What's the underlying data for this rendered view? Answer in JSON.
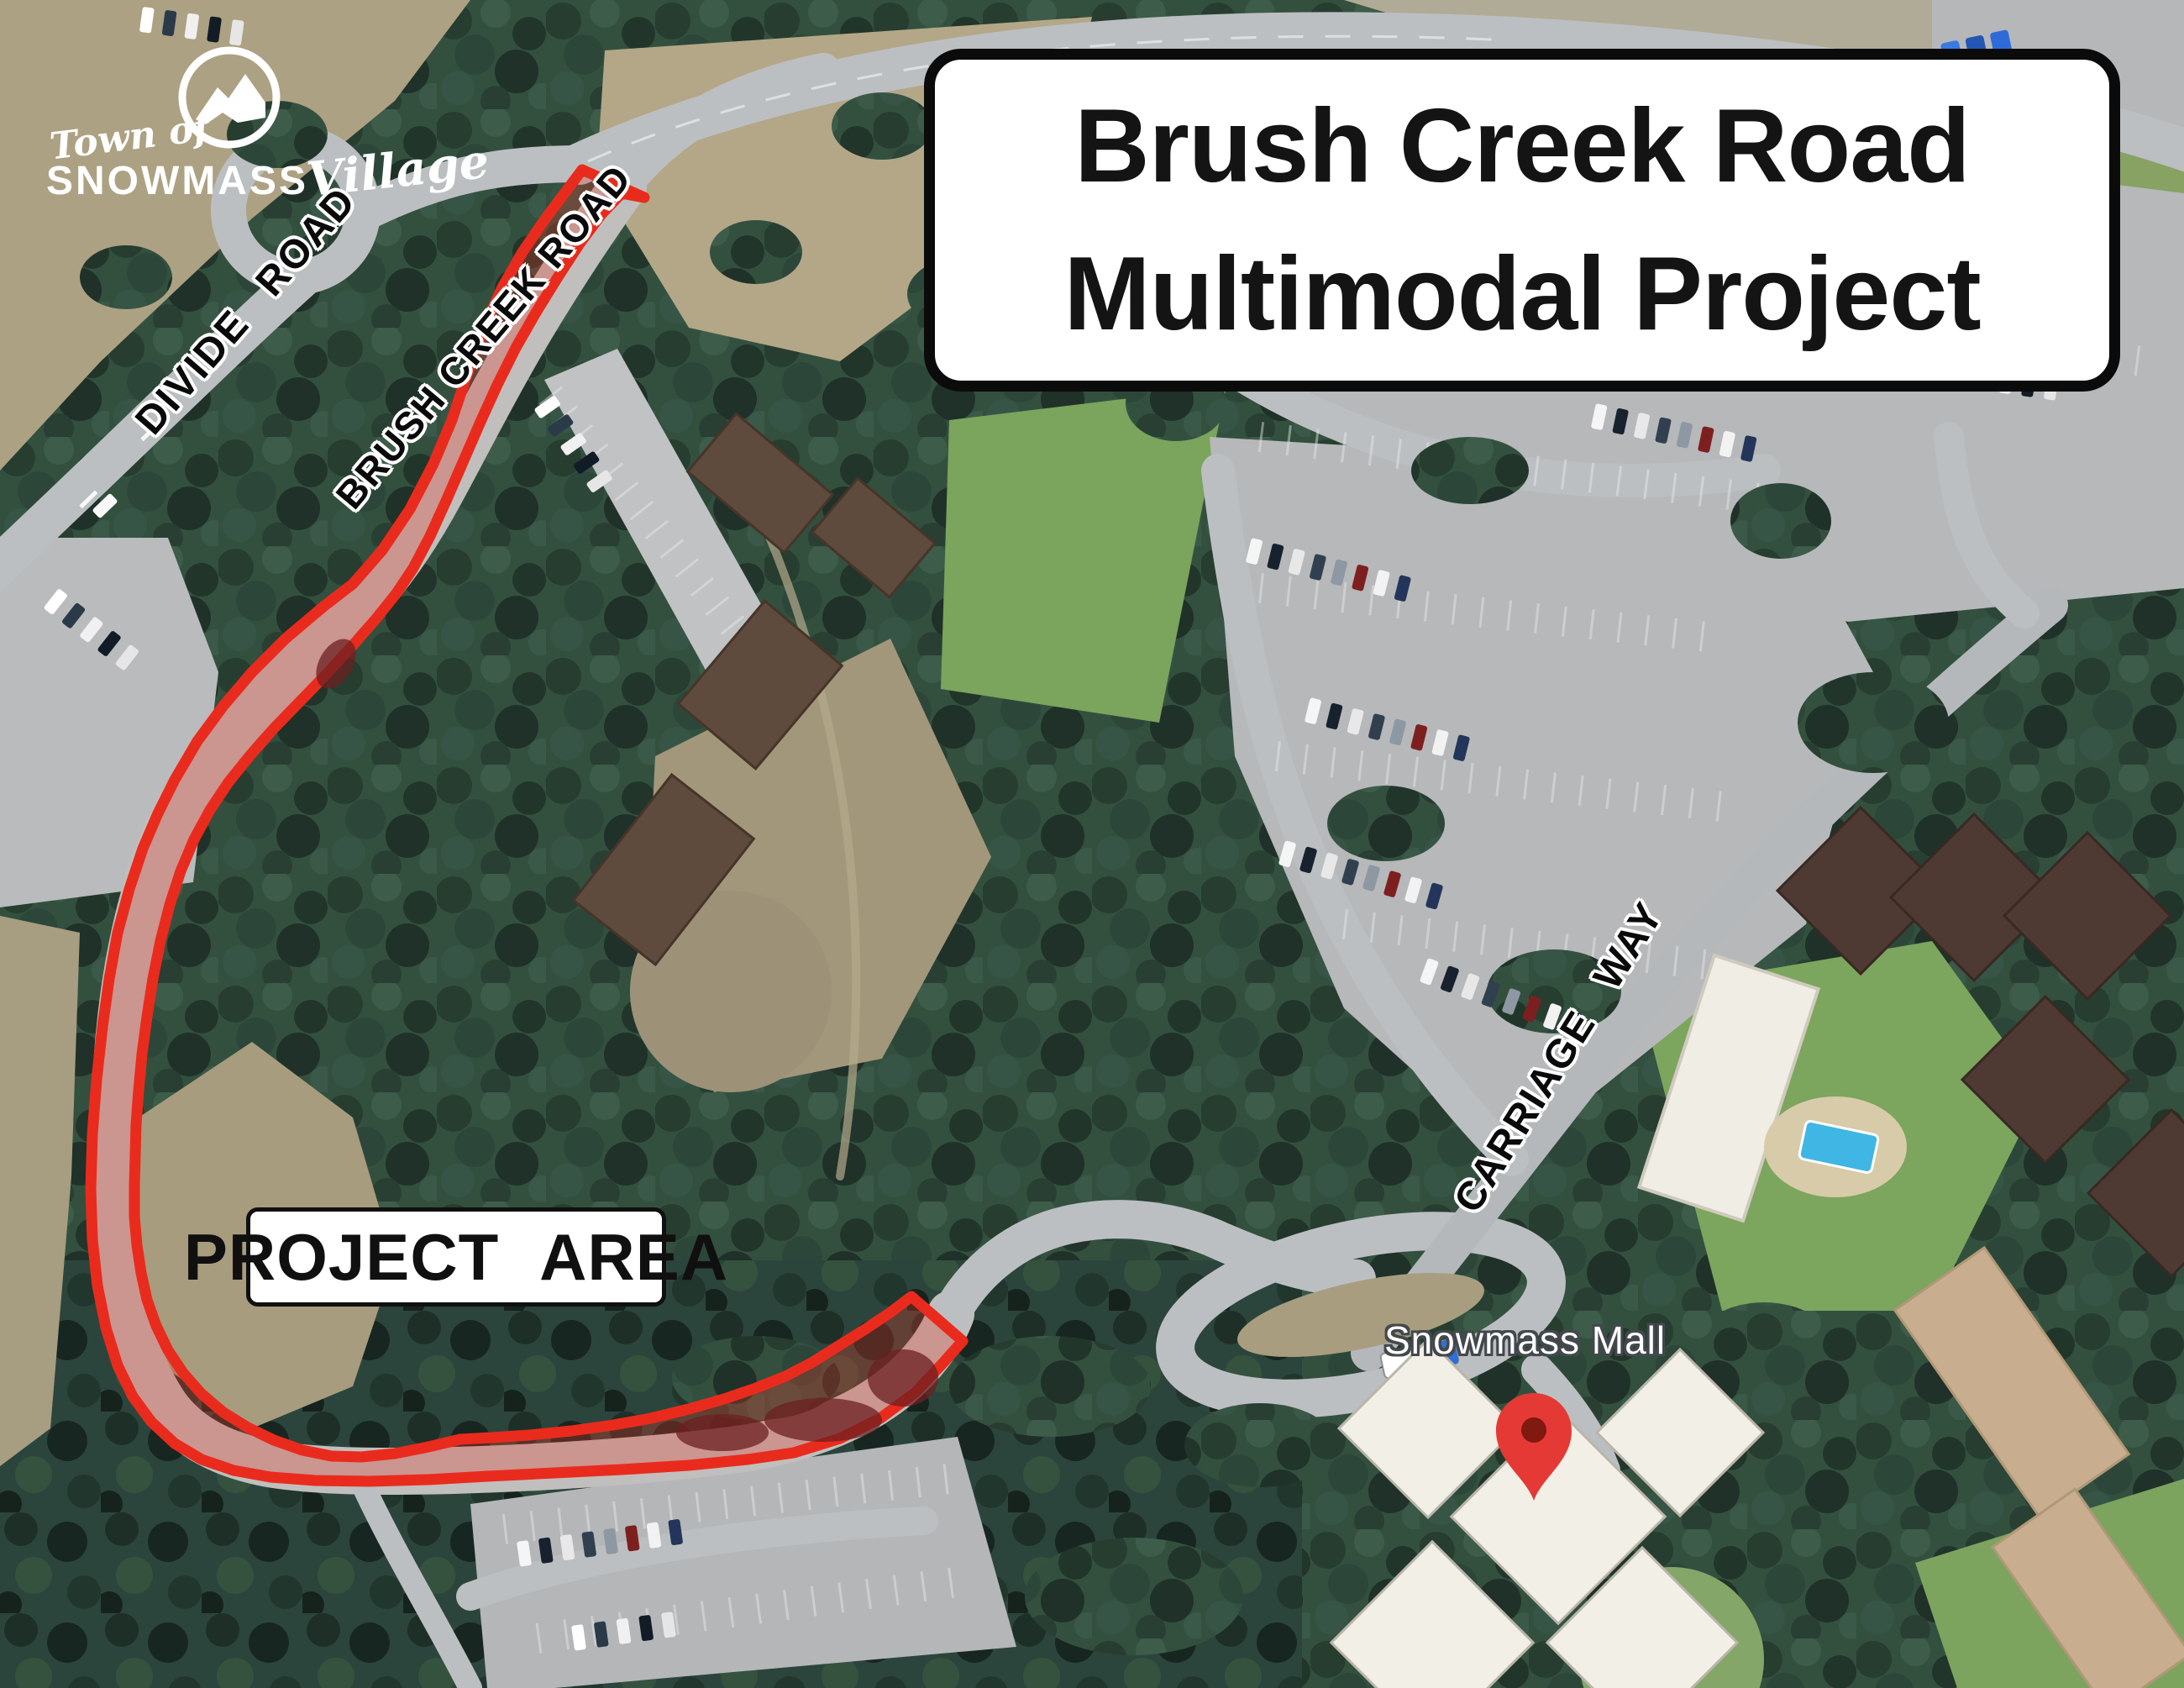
{
  "logo": {
    "line_top": "Town of",
    "line_main": "SNOWMASS",
    "line_script": "Village"
  },
  "title": {
    "line1": "Brush Creek Road",
    "line2": "Multimodal Project"
  },
  "road_labels": [
    {
      "id": "divide-road",
      "text": "DIVIDE ROAD"
    },
    {
      "id": "brush-creek-road",
      "text": "BRUSH CREEK ROAD"
    },
    {
      "id": "carriage-way",
      "text": "CARRIAGE WAY"
    }
  ],
  "project_area_label": "PROJECT AREA",
  "map_labels": {
    "snowmass_mall": "Snowmass Mall"
  },
  "colors": {
    "project_outline_red": "#e92b1d",
    "project_fill_red": "rgba(228,52,40,0.30)",
    "pin_red": "#e53935",
    "forest_green": "#33503f",
    "road_gray": "#bcbfc1"
  }
}
